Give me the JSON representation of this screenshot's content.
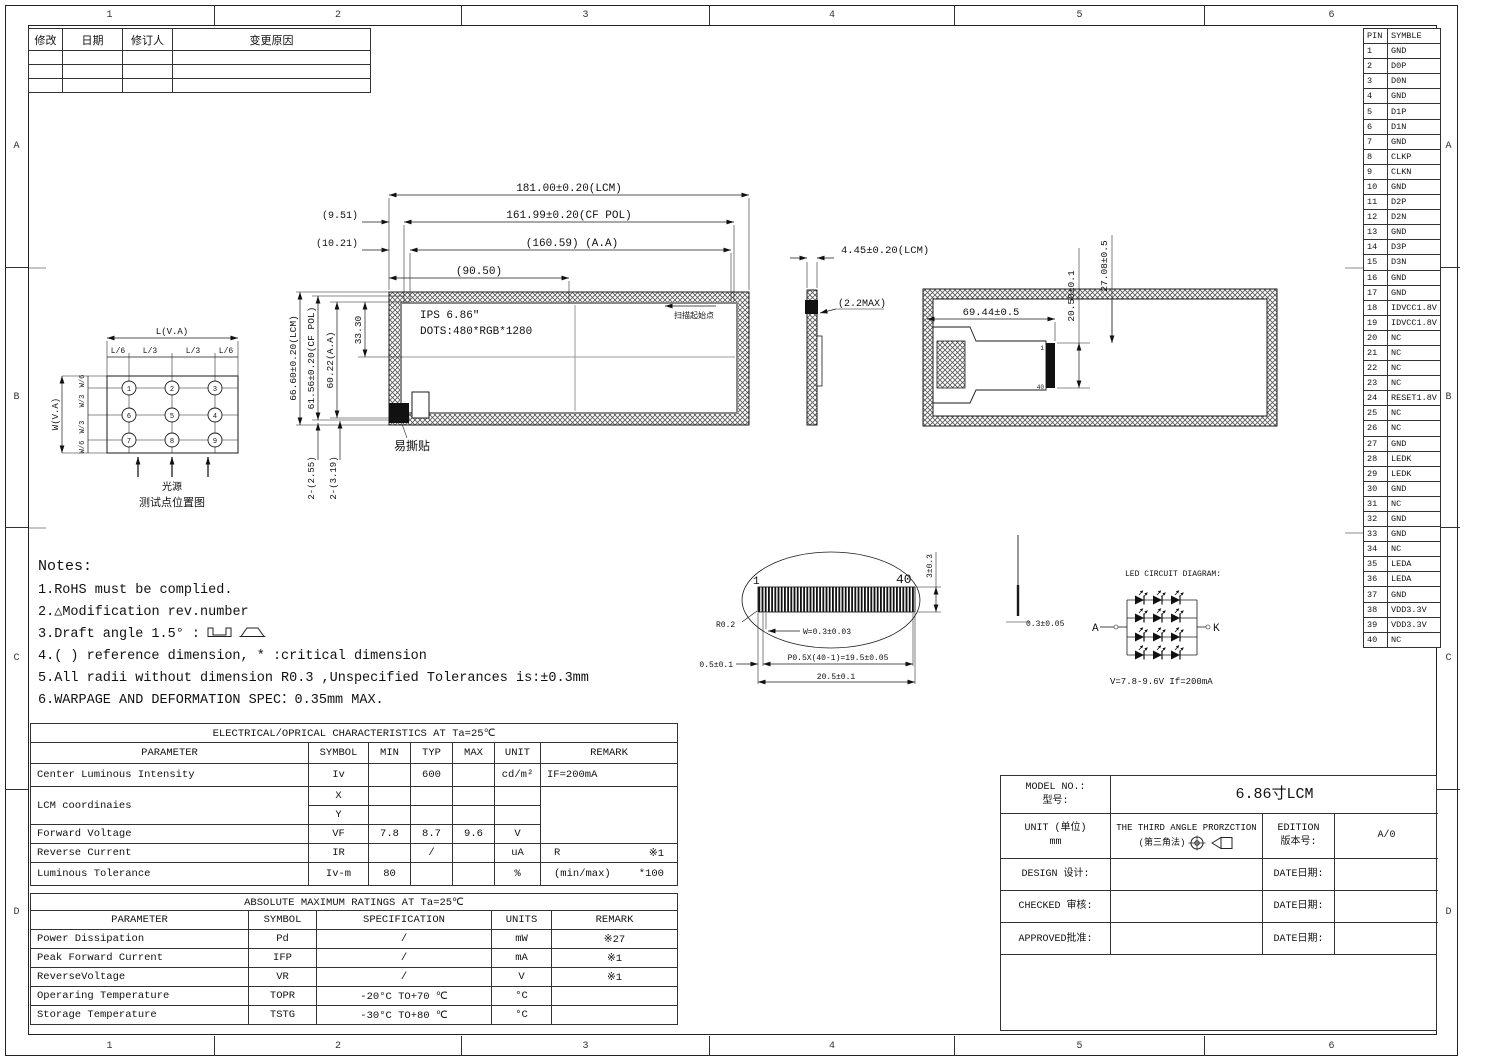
{
  "zones": {
    "cols": [
      "1",
      "2",
      "3",
      "4",
      "5",
      "6"
    ],
    "rows": [
      "A",
      "B",
      "C",
      "D"
    ]
  },
  "revision_table": {
    "headers": [
      "修改",
      "日期",
      "修订人",
      "变更原因"
    ]
  },
  "pin_table": {
    "headers": [
      "PIN",
      "SYMBLE"
    ],
    "pins": [
      {
        "pin": "1",
        "symbol": "GND"
      },
      {
        "pin": "2",
        "symbol": "D0P"
      },
      {
        "pin": "3",
        "symbol": "D0N"
      },
      {
        "pin": "4",
        "symbol": "GND"
      },
      {
        "pin": "5",
        "symbol": "D1P"
      },
      {
        "pin": "6",
        "symbol": "D1N"
      },
      {
        "pin": "7",
        "symbol": "GND"
      },
      {
        "pin": "8",
        "symbol": "CLKP"
      },
      {
        "pin": "9",
        "symbol": "CLKN"
      },
      {
        "pin": "10",
        "symbol": "GND"
      },
      {
        "pin": "11",
        "symbol": "D2P"
      },
      {
        "pin": "12",
        "symbol": "D2N"
      },
      {
        "pin": "13",
        "symbol": "GND"
      },
      {
        "pin": "14",
        "symbol": "D3P"
      },
      {
        "pin": "15",
        "symbol": "D3N"
      },
      {
        "pin": "16",
        "symbol": "GND"
      },
      {
        "pin": "17",
        "symbol": "GND"
      },
      {
        "pin": "18",
        "symbol": "IDVCC1.8V"
      },
      {
        "pin": "19",
        "symbol": "IDVCC1.8V"
      },
      {
        "pin": "20",
        "symbol": "NC"
      },
      {
        "pin": "21",
        "symbol": "NC"
      },
      {
        "pin": "22",
        "symbol": "NC"
      },
      {
        "pin": "23",
        "symbol": "NC"
      },
      {
        "pin": "24",
        "symbol": "RESET1.8V"
      },
      {
        "pin": "25",
        "symbol": "NC"
      },
      {
        "pin": "26",
        "symbol": "NC"
      },
      {
        "pin": "27",
        "symbol": "GND"
      },
      {
        "pin": "28",
        "symbol": "LEDK"
      },
      {
        "pin": "29",
        "symbol": "LEDK"
      },
      {
        "pin": "30",
        "symbol": "GND"
      },
      {
        "pin": "31",
        "symbol": "NC"
      },
      {
        "pin": "32",
        "symbol": "GND"
      },
      {
        "pin": "33",
        "symbol": "GND"
      },
      {
        "pin": "34",
        "symbol": "NC"
      },
      {
        "pin": "35",
        "symbol": "LEDA"
      },
      {
        "pin": "36",
        "symbol": "LEDA"
      },
      {
        "pin": "37",
        "symbol": "GND"
      },
      {
        "pin": "38",
        "symbol": "VDD3.3V"
      },
      {
        "pin": "39",
        "symbol": "VDD3.3V"
      },
      {
        "pin": "40",
        "symbol": "NC"
      }
    ]
  },
  "front_view": {
    "panel_line1": "IPS 6.86″",
    "panel_line2": "DOTS:480*RGB*1280",
    "scan_label": "扫描起始点",
    "tear_label": "易撕贴",
    "dims": {
      "lcm_w": "181.00±0.20(LCM)",
      "cf_pol_w": "161.99±0.20(CF POL)",
      "aa_w": "(160.59) (A.A)",
      "half_w": "(90.50)",
      "off1": "(9.51)",
      "off2": "(10.21)",
      "lcm_h": "66.60±0.20(LCM)",
      "cf_pol_h": "61.56±0.20(CF POL)",
      "aa_h": "60.22(A.A)",
      "center_h": "33.30",
      "hole1": "2-(2.55)",
      "hole2": "2-(3.19)"
    }
  },
  "side_view": {
    "thickness": "4.45±0.20(LCM)",
    "fpc_thickness": "(2.2MAX)"
  },
  "back_view": {
    "fpc_width": "69.44±0.5",
    "conn_span": "20.50±0.1",
    "conn_offset": "27.08±0.5",
    "conn_first": "1",
    "conn_last": "40"
  },
  "fpc_detail": {
    "pin_first": "1",
    "pin_last": "40",
    "height": "3±0.3",
    "radius": "R0.2",
    "pin_width": "W=0.3±0.03",
    "edge": "0.5±0.1",
    "pitch": "P0.5X(40-1)=19.5±0.05",
    "total": "20.5±0.1",
    "thickness": "0.3±0.05"
  },
  "led_circuit": {
    "title": "LED CIRCUIT DIAGRAM:",
    "anode": "A",
    "cathode": "K",
    "spec": "V=7.8-9.6V  If=200mA"
  },
  "test_diagram": {
    "l_total": "L(V.A)",
    "l_segs": [
      "L/6",
      "L/3",
      "L/3",
      "L/6"
    ],
    "w_total": "W(V.A)",
    "w_segs": [
      "W/6",
      "W/3",
      "W/3",
      "W/6"
    ],
    "points": [
      "1",
      "2",
      "3",
      "6",
      "5",
      "4",
      "7",
      "8",
      "9"
    ],
    "light_label": "光源",
    "caption": "测试点位置图"
  },
  "notes": {
    "title": "Notes:",
    "items": [
      "1.RoHS must be complied.",
      "2.△Modification rev.number",
      "3.Draft angle 1.5° :",
      "4.( ) reference dimension, * :critical dimension",
      "5.All radii without dimension R0.3 ,Unspecified Tolerances is:±0.3mm",
      "6.WARPAGE AND DEFORMATION SPEC：0.35mm MAX."
    ]
  },
  "elec_table": {
    "title": "ELECTRICAL/OPRICAL CHARACTERISTICS AT Ta=25℃",
    "headers": [
      "PARAMETER",
      "SYMBOL",
      "MIN",
      "TYP",
      "MAX",
      "UNIT",
      "REMARK"
    ],
    "r1": {
      "param": "Center Luminous Intensity",
      "sym": "Iv",
      "min": "",
      "typ": "600",
      "max": "",
      "unit": "cd/m²",
      "remark": "IF=200mA"
    },
    "r2": {
      "param": "LCM coordinaies",
      "sym_x": "X",
      "sym_y": "Y"
    },
    "r3": {
      "param": "Forward Voltage",
      "sym": "VF",
      "min": "7.8",
      "typ": "8.7",
      "max": "9.6",
      "unit": "V"
    },
    "r4": {
      "param": "Reverse Current",
      "sym": "IR",
      "typ": "/",
      "unit": "uA",
      "remark_l": "R",
      "remark_r": "※1"
    },
    "r5": {
      "param": "Luminous Tolerance",
      "sym": "Iv-m",
      "min": "80",
      "unit": "%",
      "remark_l": "(min/max)",
      "remark_r": "*100"
    }
  },
  "ratings_table": {
    "title": "ABSOLUTE MAXIMUM RATINGS AT Ta=25℃",
    "headers": [
      "PARAMETER",
      "SYMBOL",
      "SPECIFICATION",
      "UNITS",
      "REMARK"
    ],
    "rows": [
      {
        "param": "Power Dissipation",
        "sym": "Pd",
        "spec": "/",
        "unit": "mW",
        "remark": "※27"
      },
      {
        "param": "Peak Forward Current",
        "sym": "IFP",
        "spec": "/",
        "unit": "mA",
        "remark": "※1"
      },
      {
        "param": "ReverseVoltage",
        "sym": "VR",
        "spec": "/",
        "unit": "V",
        "remark": "※1"
      },
      {
        "param": "Operaring Temperature",
        "sym": "TOPR",
        "spec": "-20°C TO+70 ℃",
        "unit": "°C",
        "remark": ""
      },
      {
        "param": "Storage Temperature",
        "sym": "TSTG",
        "spec": "-30°C TO+80 ℃",
        "unit": "°C",
        "remark": ""
      }
    ]
  },
  "title_block": {
    "model_label": "MODEL NO.:",
    "model_label_cn": "型号:",
    "model_value": "6.86寸LCM",
    "unit_label": "UNIT (单位)",
    "unit_value": "mm",
    "projection": "THE THIRD ANGLE PRORZCTION",
    "projection_cn": "(第三角法)",
    "edition_label": "EDITION",
    "edition_label_cn": "版本号:",
    "edition_value": "A/0",
    "design_label": "DESIGN  设计:",
    "checked_label": "CHECKED 审核:",
    "approved_label": "APPROVED批准:",
    "date_label": "DATE日期:"
  },
  "colors": {
    "line": "#1a1a1a",
    "background": "#ffffff"
  }
}
